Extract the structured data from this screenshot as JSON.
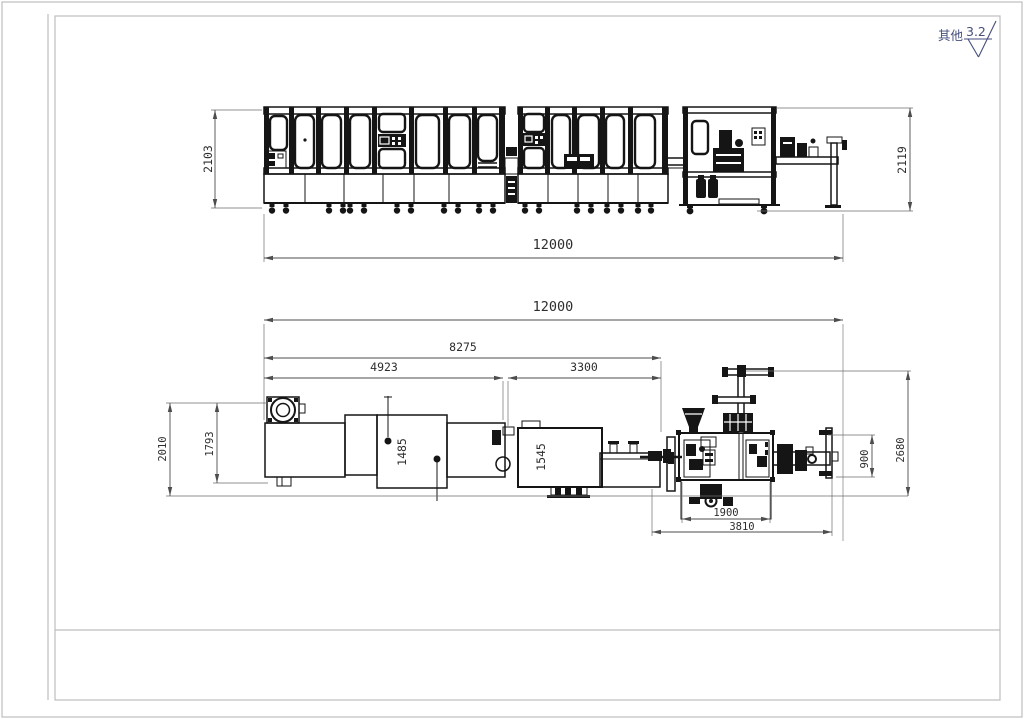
{
  "colors": {
    "line": "#151515",
    "dimension": "#4d4d4d",
    "frame": "#bdbdbd",
    "annotation": "#454e7d"
  },
  "annotations": {
    "other_label": "其他",
    "roughness_value": "3.2"
  },
  "elevation": {
    "height_left": "2103",
    "height_right": "2119",
    "overall_length": "12000"
  },
  "plan": {
    "overall_length": "12000",
    "upper_length": "8275",
    "left_segment": "4923",
    "mid_segment": "3300",
    "depth_total": "2010",
    "depth_body": "1793",
    "bay_width_1485": "1485",
    "bay_width_1545": "1545",
    "right_depth": "2680",
    "right_offset": "900",
    "base_width": "1900",
    "outfeed_width": "3810"
  }
}
